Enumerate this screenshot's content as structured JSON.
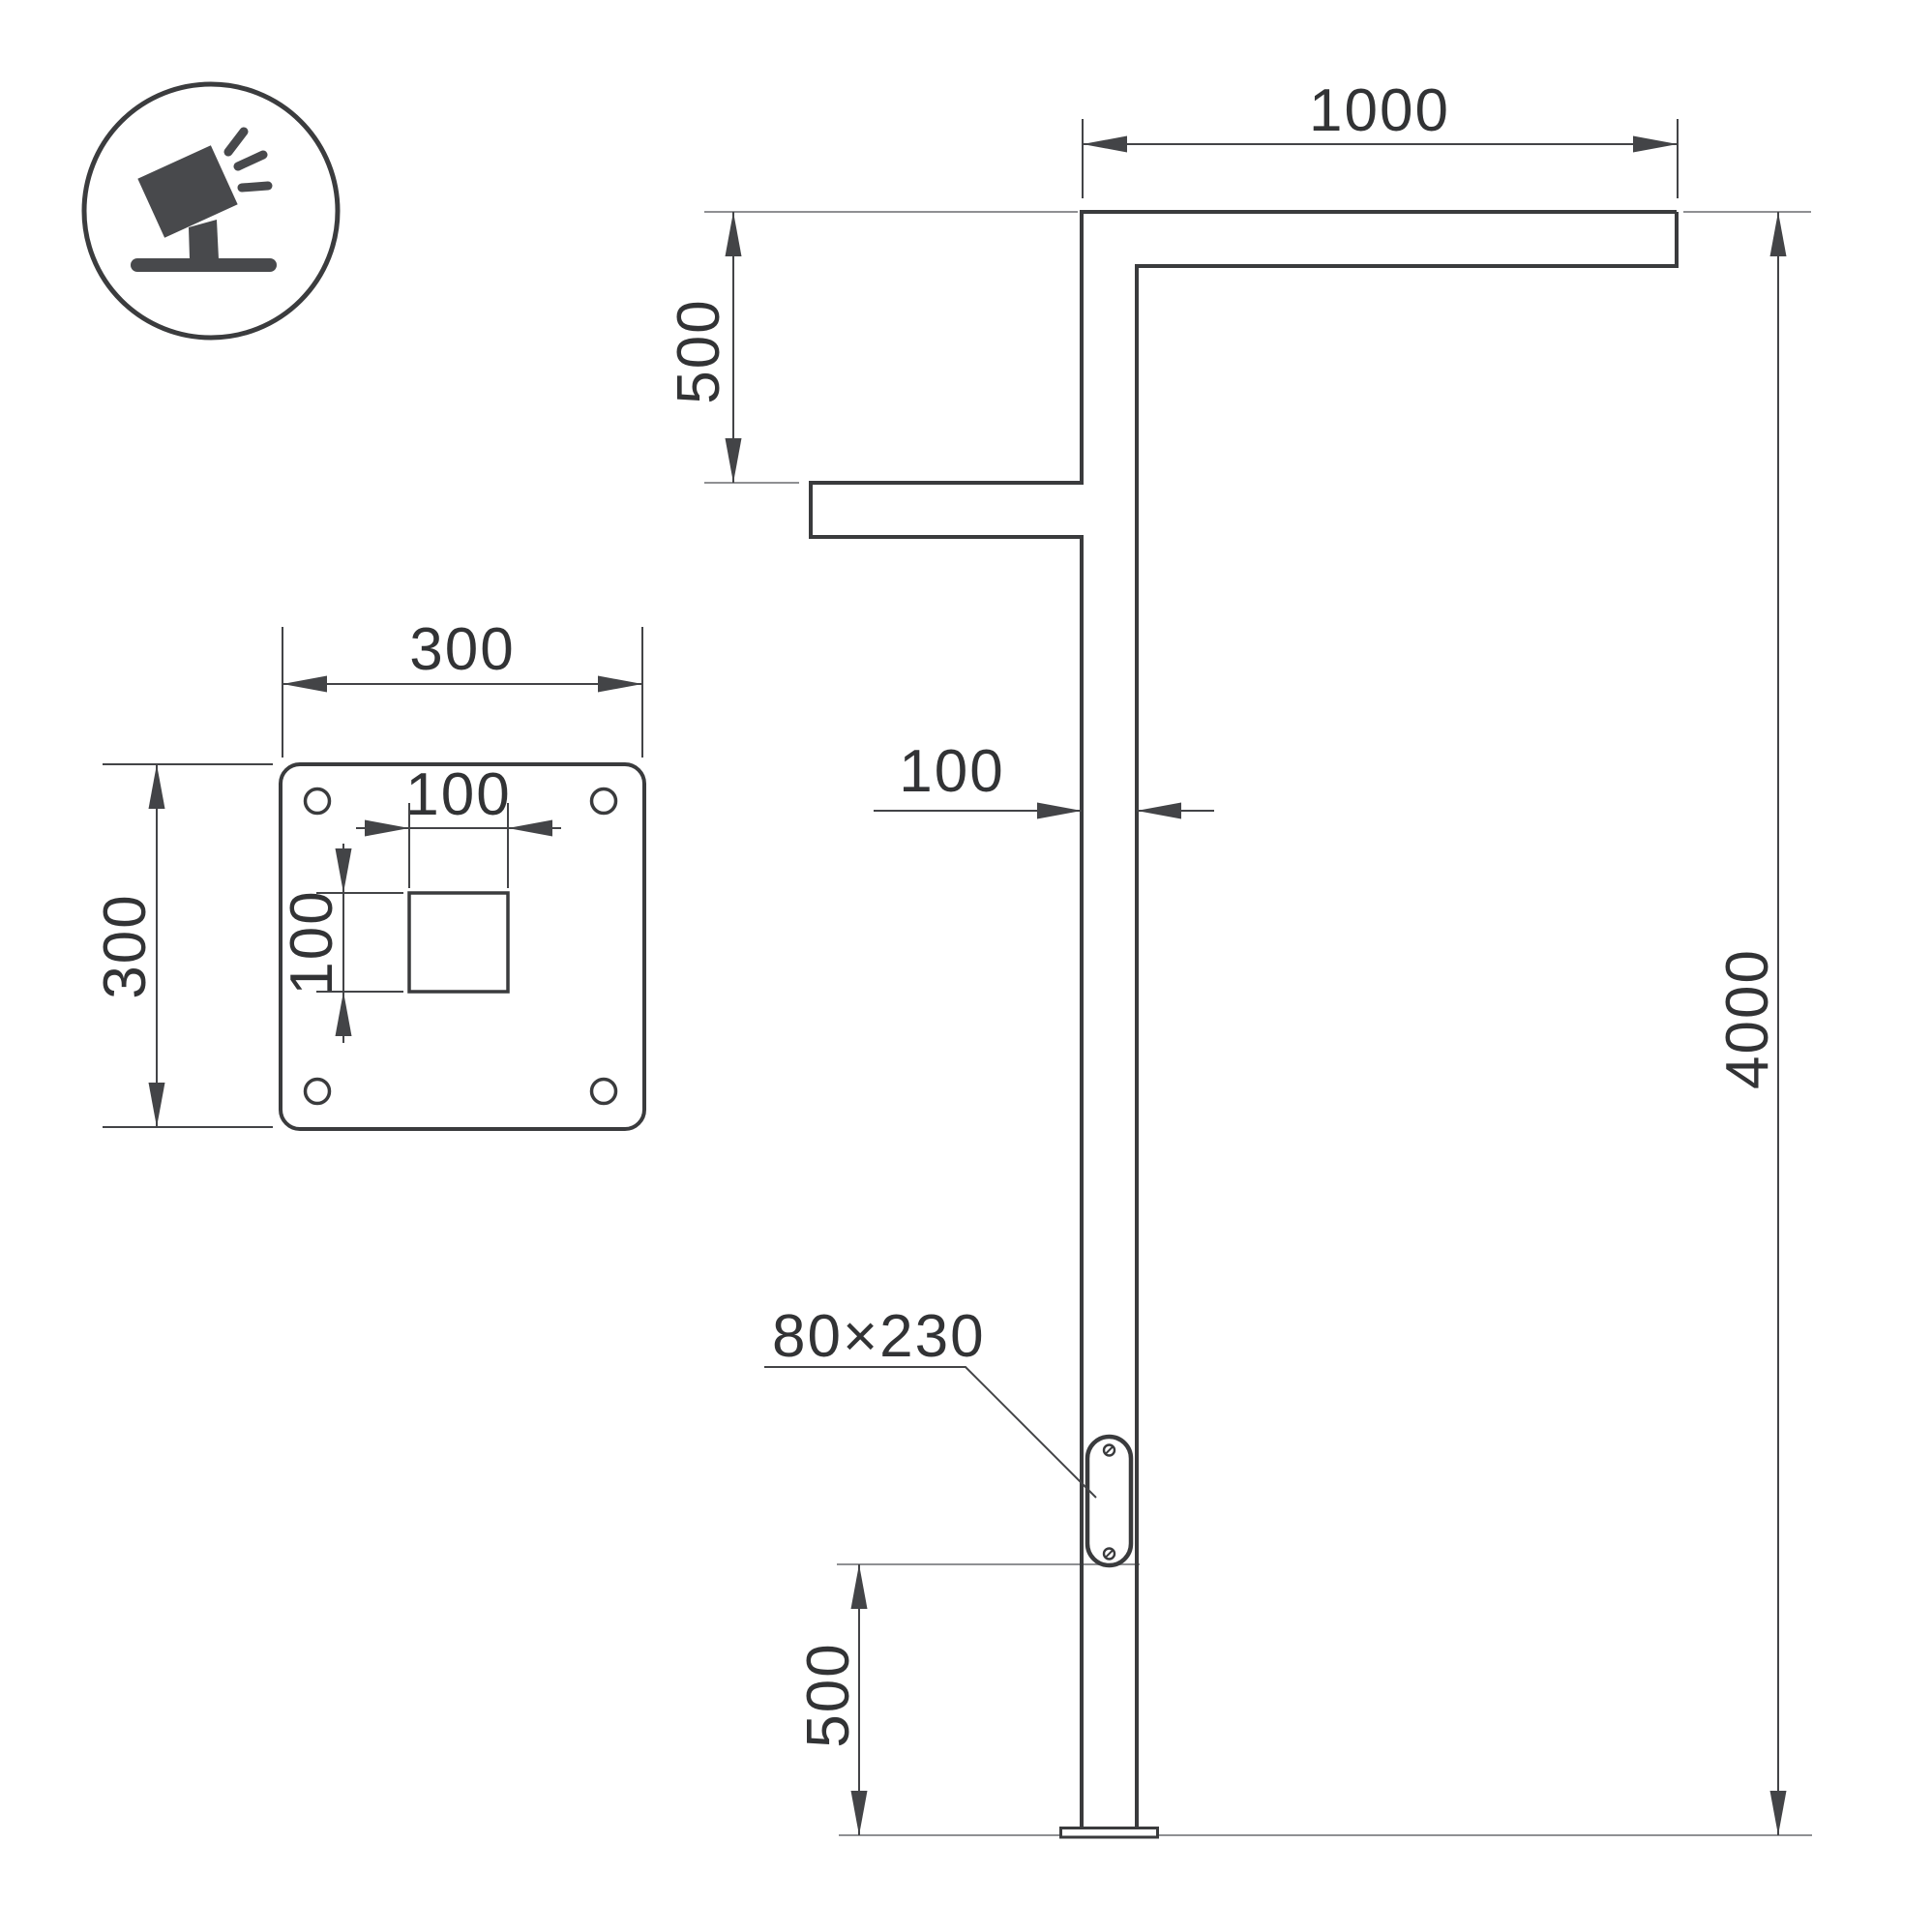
{
  "drawing": {
    "kind": "technical dimension drawing",
    "units": "mm",
    "colors": {
      "outline": "#3a3b3d",
      "dimension": "#434447",
      "reference": "#8f9093",
      "text": "#323335",
      "icon": "#48494c",
      "background": "#ffffff"
    },
    "icon": {
      "name": "tilted-floodlight-on-stand"
    },
    "base_plate_view": {
      "plate_width_label": "300",
      "plate_height_label": "300",
      "hole_width_label": "100",
      "hole_height_label": "100"
    },
    "elevation_view": {
      "arm_length_label": "1000",
      "arm_drop_label": "500",
      "pole_width_label": "100",
      "pole_height_label": "4000",
      "access_panel_label": "80×230",
      "panel_offset_label": "500"
    }
  }
}
